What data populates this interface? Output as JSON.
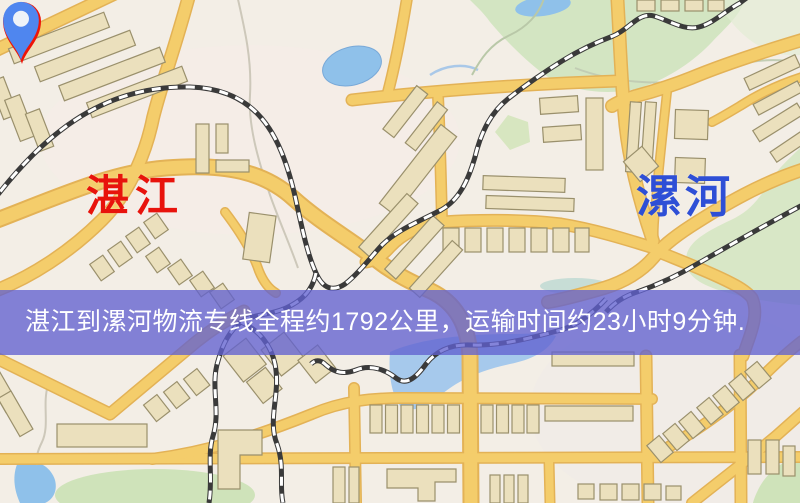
{
  "map": {
    "origin": {
      "name": "湛江",
      "pin_color": "#ee1408",
      "label_color": "#e8130c"
    },
    "destination": {
      "name": "漯河",
      "pin_color": "#4f86ef",
      "label_color": "#2e4fd6"
    },
    "banner": {
      "text": "湛江到漯河物流专线全程约1792公里，运输时间约23小时9分钟.",
      "background_color": "#6261cf",
      "text_color": "#ffffff"
    },
    "route": {
      "distance_text": "约1792公里",
      "duration_text": "约23小时9分钟"
    },
    "legend_colors": {
      "road": "#f4cd6b",
      "railway": "#3a3a3a",
      "park": "#d3e5c2",
      "water": "#8fc1ea",
      "building": "#ebe0bd"
    }
  }
}
